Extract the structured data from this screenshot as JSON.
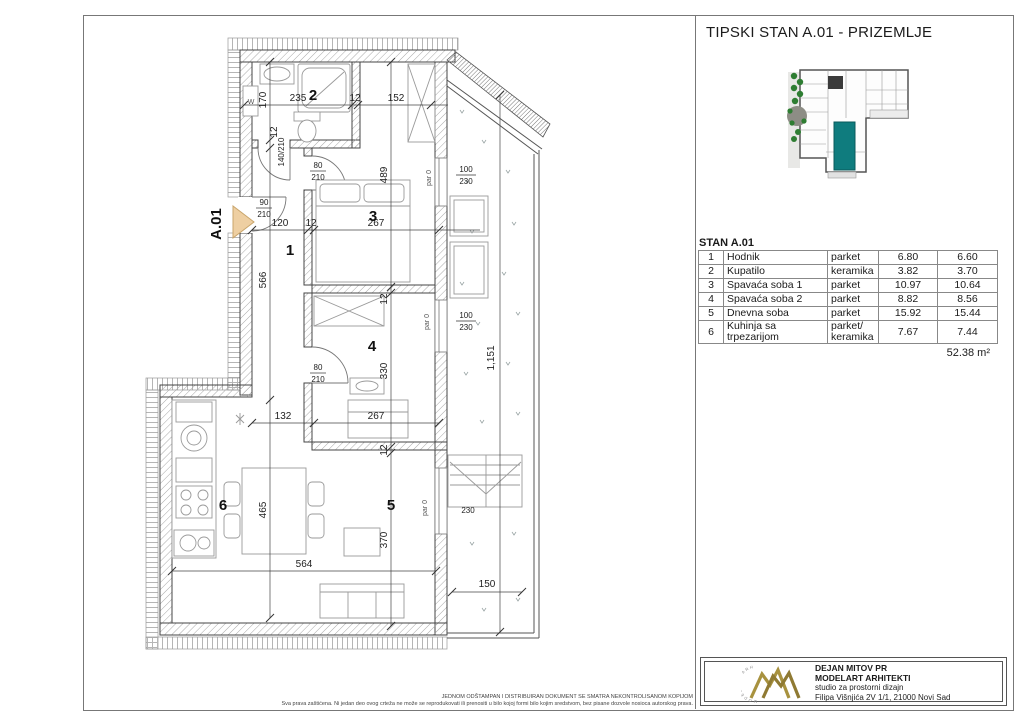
{
  "title": "TIPSKI STAN A.01 - PRIZEMLJE",
  "unit": {
    "label": "STAN A.01",
    "total_area": "52.38 m²",
    "rooms": [
      {
        "num": "1",
        "name": "Hodnik",
        "floor": "parket",
        "area_net": "6.80",
        "area_corr": "6.60"
      },
      {
        "num": "2",
        "name": "Kupatilo",
        "floor": "keramika",
        "area_net": "3.82",
        "area_corr": "3.70"
      },
      {
        "num": "3",
        "name": "Spavaća soba 1",
        "floor": "parket",
        "area_net": "10.97",
        "area_corr": "10.64"
      },
      {
        "num": "4",
        "name": "Spavaća soba 2",
        "floor": "parket",
        "area_net": "8.82",
        "area_corr": "8.56"
      },
      {
        "num": "5",
        "name": "Dnevna soba",
        "floor": "parket",
        "area_net": "15.92",
        "area_corr": "15.44"
      },
      {
        "num": "6",
        "name": "Kuhinja sa trpezarijom",
        "floor": "parket/ keramika",
        "area_net": "7.67",
        "area_corr": "7.44"
      }
    ]
  },
  "plan": {
    "entrance_label": "A.01",
    "room_numbers": {
      "r1": "1",
      "r2": "2",
      "r3": "3",
      "r4": "4",
      "r5": "5",
      "r6": "6"
    },
    "dims": {
      "bath_w": "235",
      "wall_a": "12",
      "top_right": "152",
      "bath_h": "170",
      "hall_w": "120",
      "wall_b": "12",
      "room3_w": "267",
      "room3_h": "489",
      "hall_len": "566",
      "wall_c": "12",
      "room4_h": "330",
      "wall_e": "12",
      "kitchen_gap": "132",
      "room5_w": "267",
      "wall_d": "12",
      "room5_h": "370",
      "kitchen_h": "465",
      "bottom_w": "564",
      "terrace_len": "1,151",
      "terrace_w": "150",
      "stairs_w": "230"
    },
    "doors": {
      "entrance_n": "90",
      "entrance_d": "210",
      "left_win": "140/210",
      "bath_n": "80",
      "bath_d": "210",
      "room4_n": "80",
      "room4_d": "210",
      "win1_n": "100",
      "win1_d": "230",
      "win2_n": "100",
      "win2_d": "230"
    },
    "par0": "par 0",
    "washer": "W"
  },
  "company": {
    "name": "DEJAN MITOV PR",
    "studio": "MODELART ARHITEKTI",
    "tagline": "studio za prostorni dizajn",
    "address": "Filipa Višnjića 2V 1/1, 21000 Novi Sad"
  },
  "footer": {
    "line1": "JEDNOM ODŠTAMPAN I DISTRIBUIRAN DOKUMENT SE SMATRA NEKONTROLISANOM KOPIJOM",
    "line2": "Sva prava zaštićena. Ni jedan deo ovog crteža ne može se reprodukovati ili prenositi u bilo kojoj formi bilo kojim sredstvom, bez pisane dozvole nosioca autorskog prava."
  },
  "colors": {
    "unit_highlight": "#0f7c7e",
    "logo_gold": "#a8923f",
    "entrance_marker": "#eecfa2"
  }
}
